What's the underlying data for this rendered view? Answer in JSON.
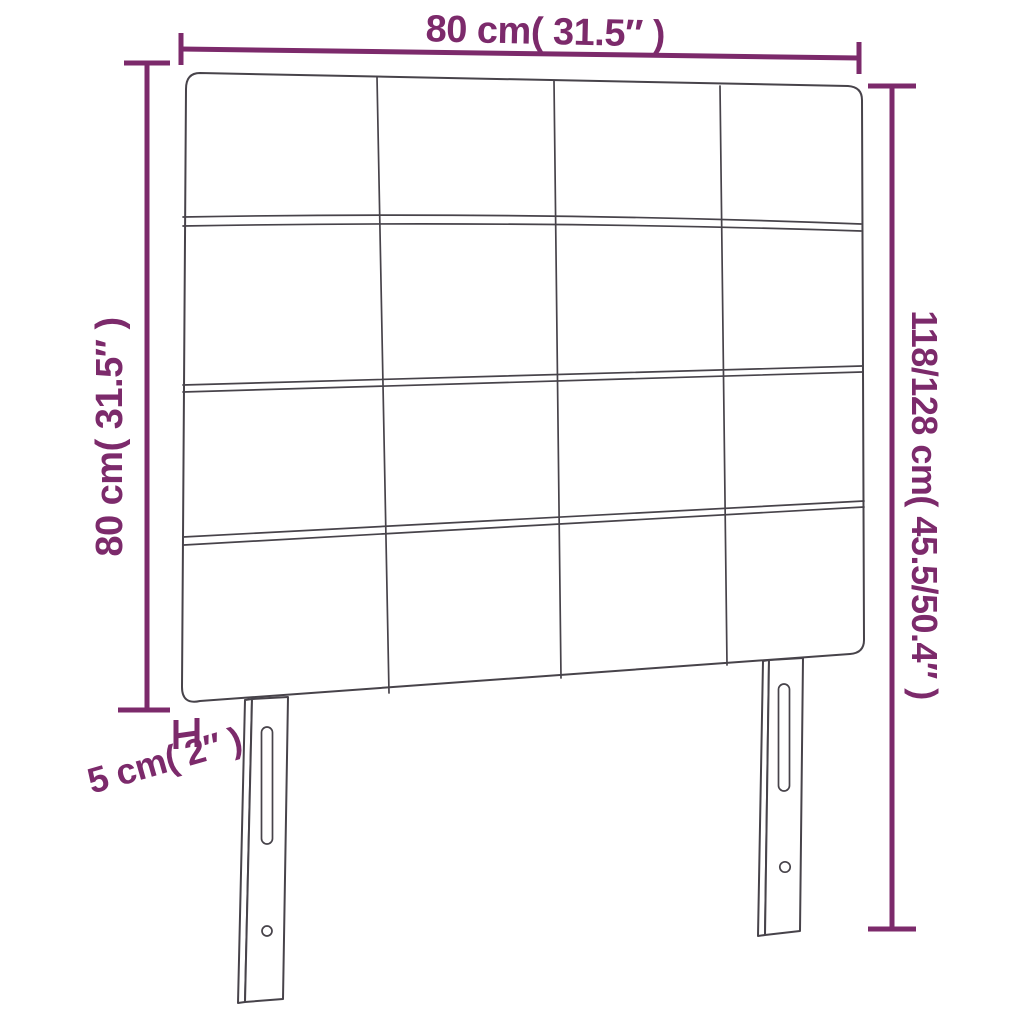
{
  "labels": {
    "width_top": "80 cm( 31.5″ )",
    "height_left": "80 cm( 31.5″ )",
    "height_right": "118/128 cm( 45.5/50.4″ )",
    "thickness_bottom": "5 cm( 2″ )"
  },
  "colors": {
    "dimension": "#7c2a6b",
    "outline": "#47434a",
    "background": "#ffffff"
  }
}
